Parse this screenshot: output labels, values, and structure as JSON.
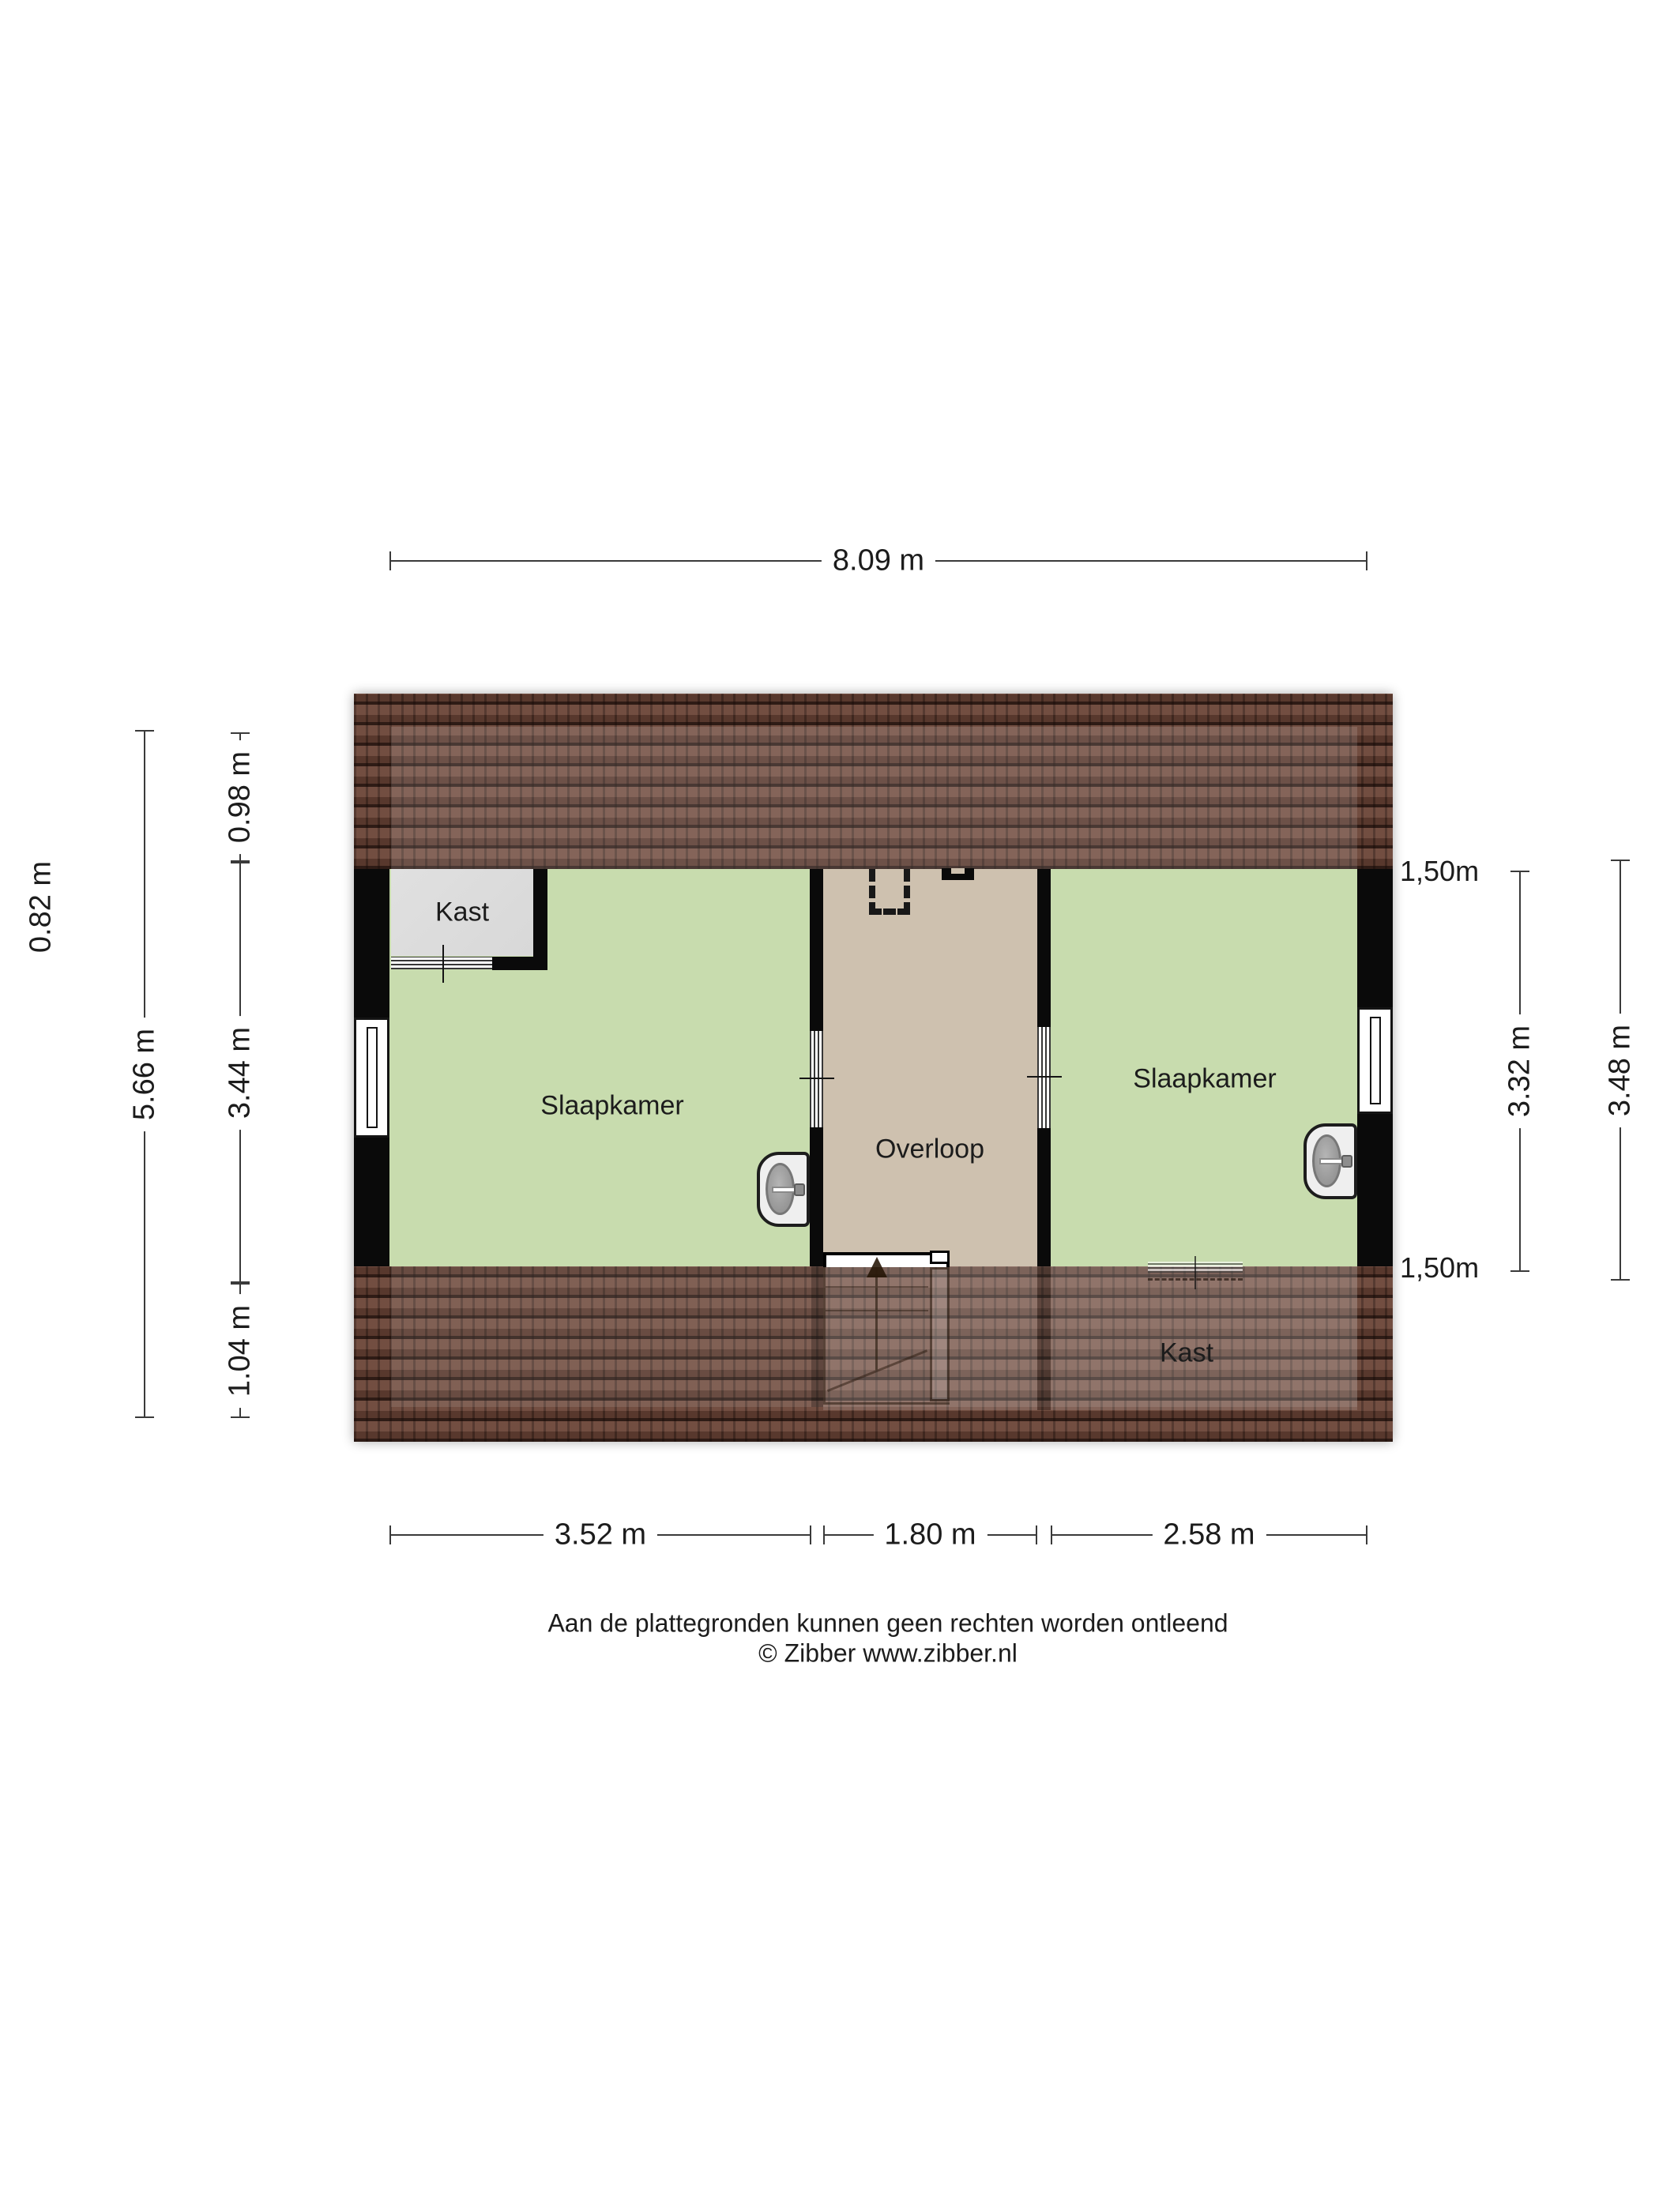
{
  "rooms": {
    "bedroom_left": "Slaapkamer",
    "bedroom_right": "Slaapkamer",
    "hallway": "Overloop",
    "closet_top": "Kast",
    "closet_under_roof": "Kast"
  },
  "dimensions": {
    "top_width": "8.09 m",
    "left_offset": "0.82 m",
    "left_total": "5.66 m",
    "left_segments": [
      "0.98 m",
      "3.44 m",
      "1.04 m"
    ],
    "right_inner": "3.32 m",
    "right_total": "3.48 m",
    "knee_wall_top": "1,50m",
    "knee_wall_bottom": "1,50m",
    "bottom_segments": [
      "3.52 m",
      "1.80 m",
      "2.58 m"
    ]
  },
  "footer": {
    "line1": "Aan de plattegronden kunnen geen rechten worden ontleend",
    "line2": "© Zibber www.zibber.nl"
  },
  "colors": {
    "room_green": "#c8dcae",
    "hallway_tan": "#cec1af",
    "closet_gray": "#d8d8d8",
    "wall": "#0a0a0a",
    "roof_base": "#6b4437",
    "dim_line": "#3a3a3a",
    "text": "#1c1c1c"
  }
}
